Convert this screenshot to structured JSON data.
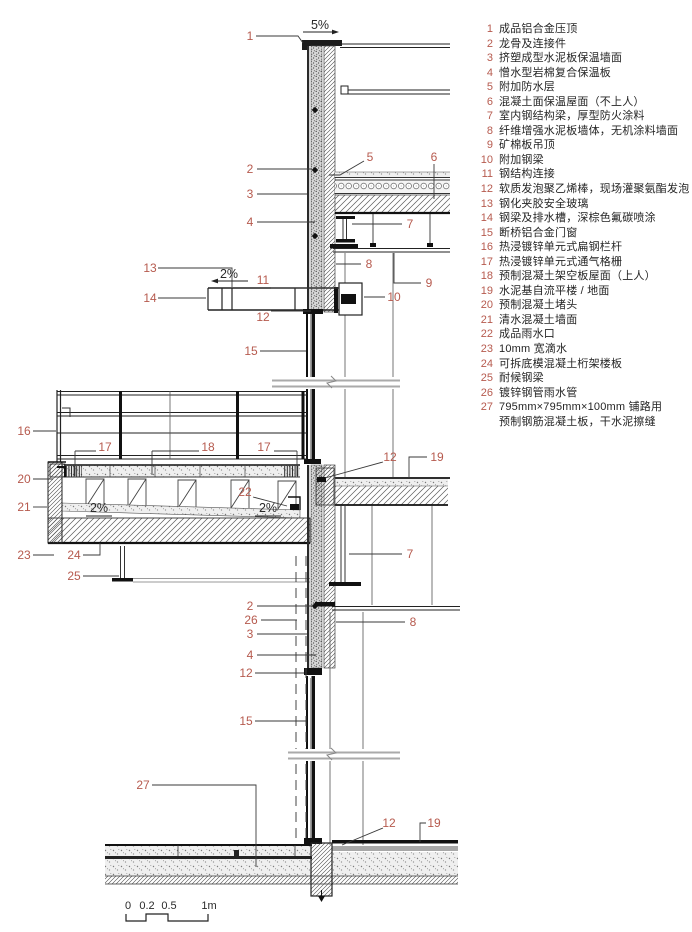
{
  "legend": {
    "items": [
      {
        "num": "1",
        "text": "成品铝合金压顶"
      },
      {
        "num": "2",
        "text": "龙骨及连接件"
      },
      {
        "num": "3",
        "text": "挤塑成型水泥板保温墙面"
      },
      {
        "num": "4",
        "text": "憎水型岩棉复合保温板"
      },
      {
        "num": "5",
        "text": "附加防水层"
      },
      {
        "num": "6",
        "text": "混凝土面保温屋面（不上人）"
      },
      {
        "num": "7",
        "text": "室内钢结构梁，厚型防火涂料"
      },
      {
        "num": "8",
        "text": "纤维增强水泥板墙体，无机涂料墙面"
      },
      {
        "num": "9",
        "text": "矿棉板吊顶"
      },
      {
        "num": "10",
        "text": "附加钢梁"
      },
      {
        "num": "11",
        "text": "钢结构连接"
      },
      {
        "num": "12",
        "text": "软质发泡聚乙烯棒，现场灌聚氨酯发泡"
      },
      {
        "num": "13",
        "text": "钢化夹胶安全玻璃"
      },
      {
        "num": "14",
        "text": "钢梁及排水槽，深棕色氟碳喷涂"
      },
      {
        "num": "15",
        "text": "断桥铝合金门窗"
      },
      {
        "num": "16",
        "text": "热浸镀锌单元式扁钢栏杆"
      },
      {
        "num": "17",
        "text": "热浸镀锌单元式通气格栅"
      },
      {
        "num": "18",
        "text": "预制混凝土架空板屋面（上人）"
      },
      {
        "num": "19",
        "text": "水泥基自流平楼 / 地面"
      },
      {
        "num": "20",
        "text": "预制混凝土堵头"
      },
      {
        "num": "21",
        "text": "清水混凝土墙面"
      },
      {
        "num": "22",
        "text": "成品雨水口"
      },
      {
        "num": "23",
        "text": "10mm 宽滴水"
      },
      {
        "num": "24",
        "text": "可拆底模混凝土桁架楼板"
      },
      {
        "num": "25",
        "text": "耐候钢梁"
      },
      {
        "num": "26",
        "text": "镀锌钢管雨水管"
      },
      {
        "num": "27",
        "text": "795mm×795mm×100mm 铺路用",
        "text2": "预制钢筋混凝土板，干水泥擦缝"
      }
    ]
  },
  "drawing": {
    "slopes": {
      "parapet": "5%",
      "canopy": "2%",
      "terrace_left": "2%",
      "terrace_right": "2%"
    },
    "scale_bar": {
      "tick0": "0",
      "tick1": "0.2",
      "tick2": "0.5",
      "tick3": "1m"
    },
    "colors": {
      "callout": "#b65a4e",
      "line": "#1c1c1c"
    }
  }
}
